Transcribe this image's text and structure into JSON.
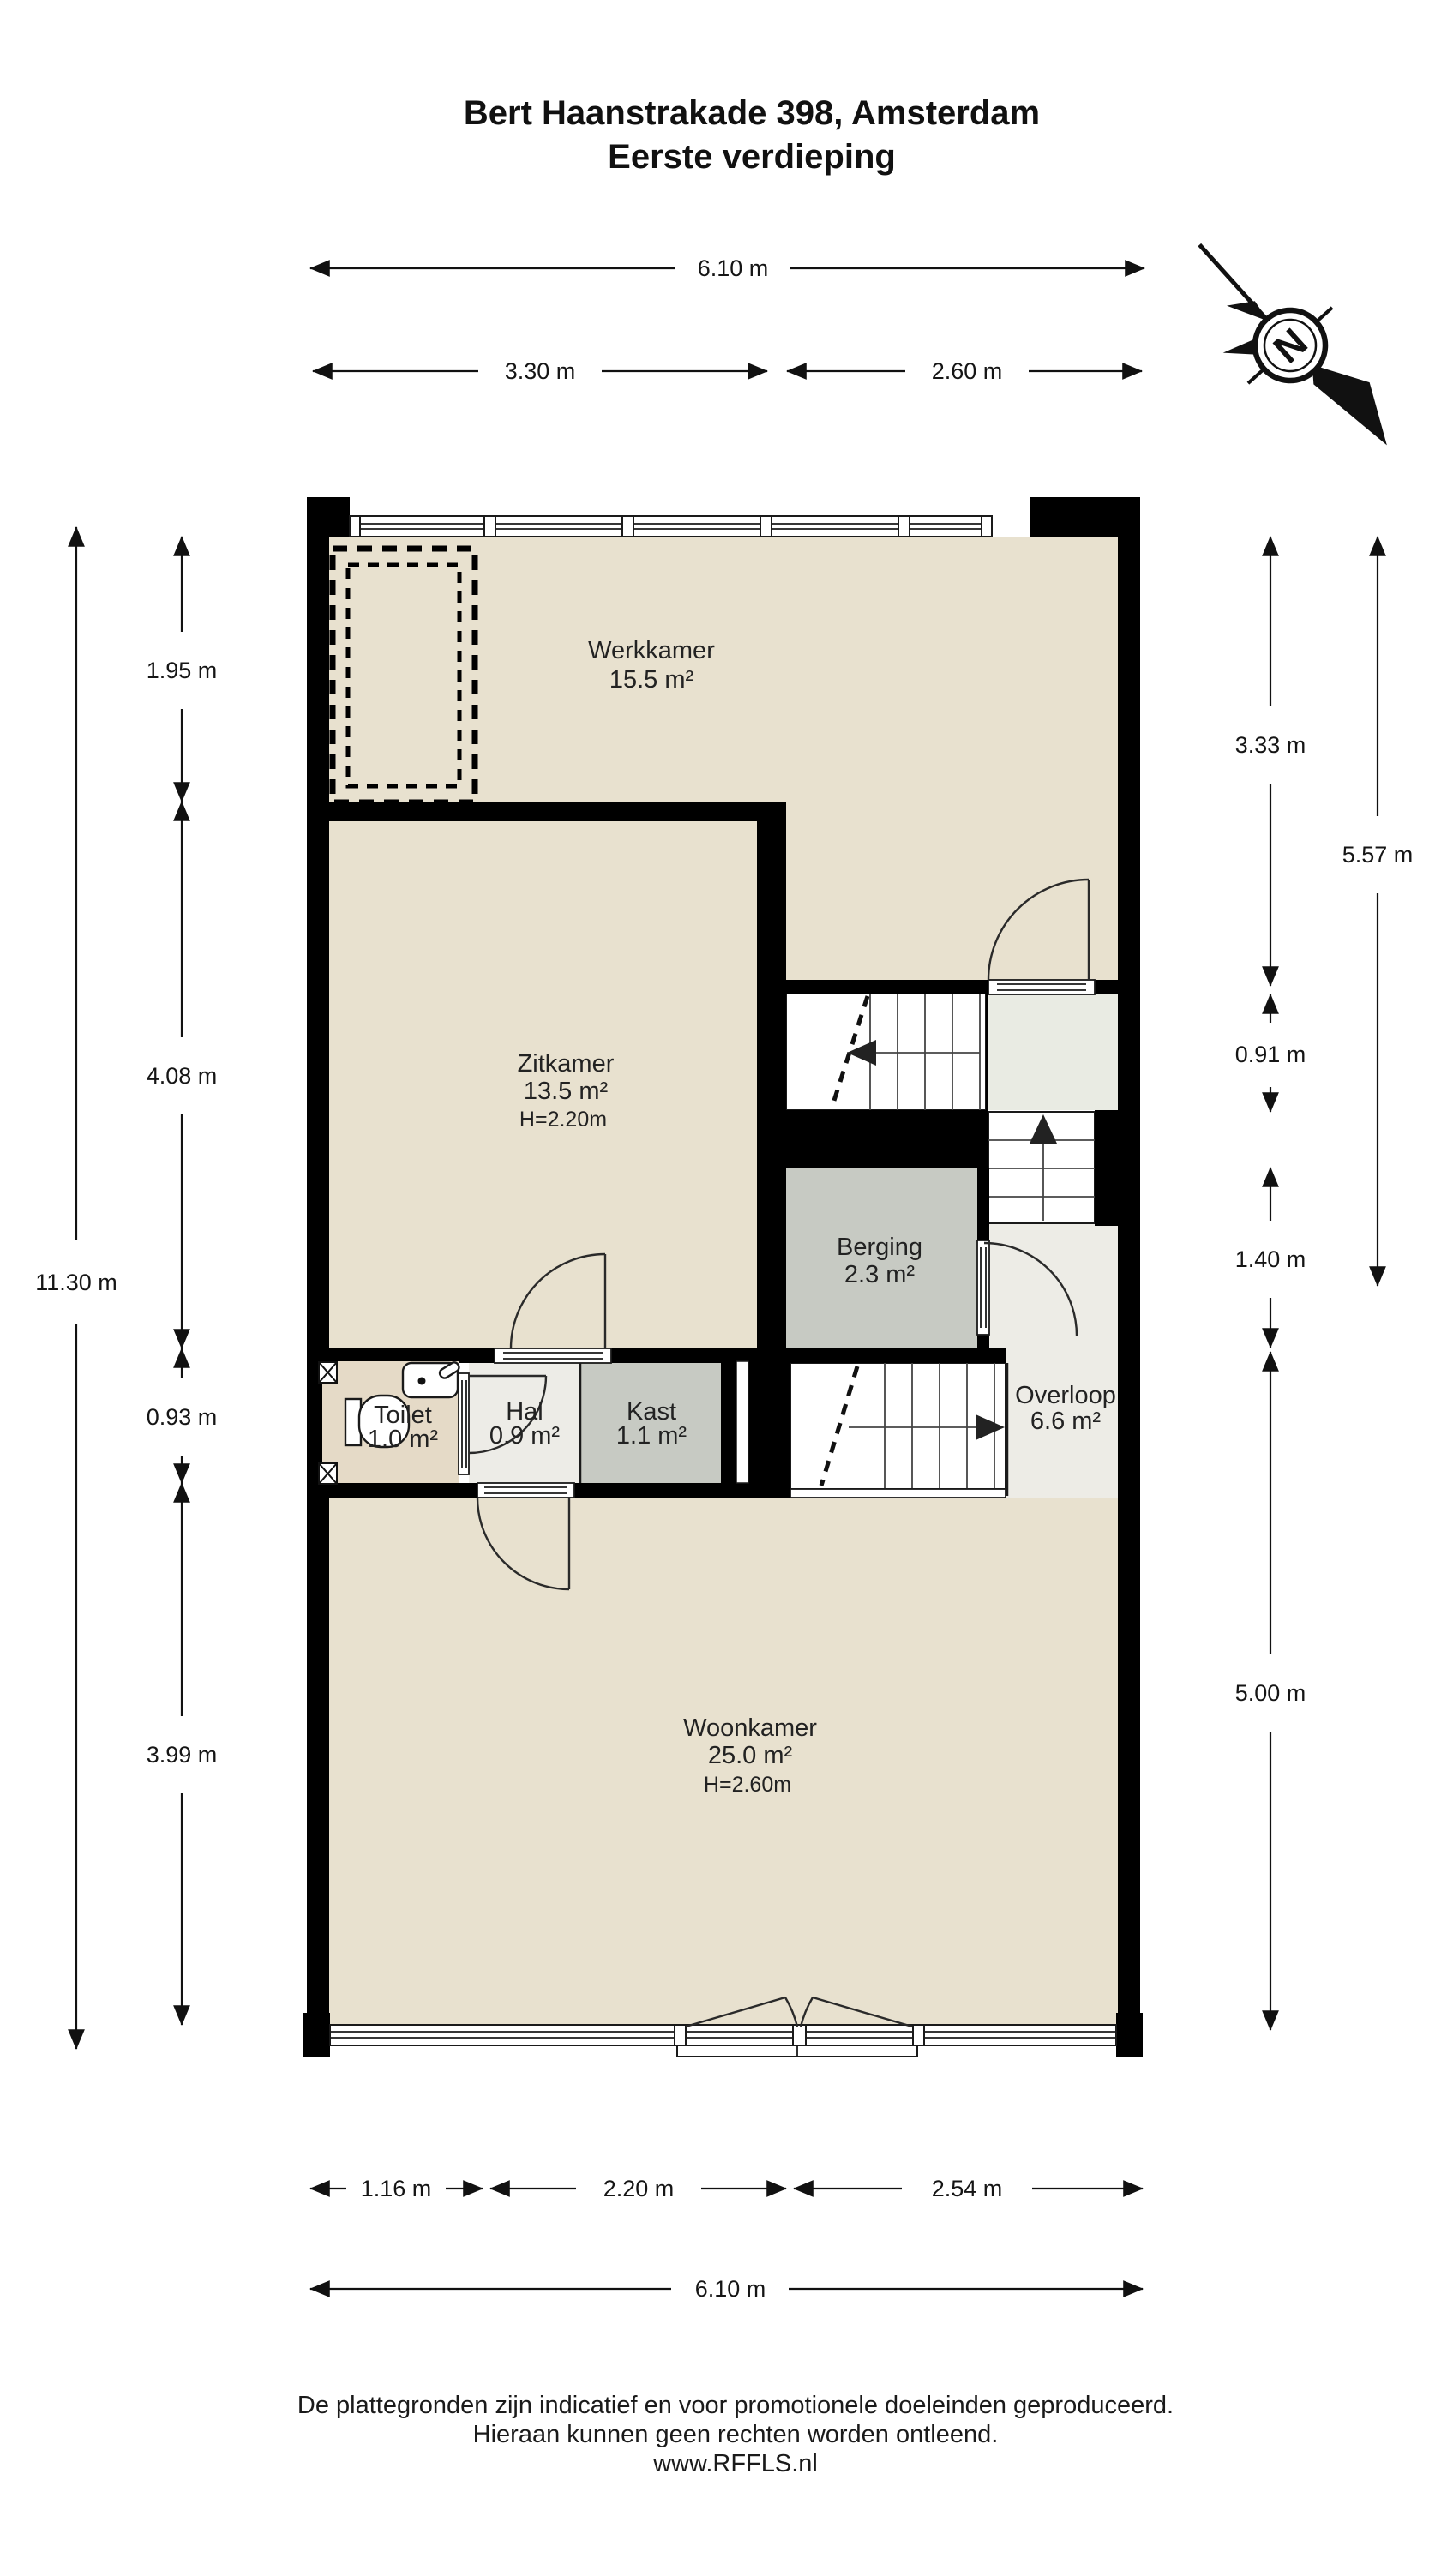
{
  "title": {
    "line1": "Bert Haanstrakade 398, Amsterdam",
    "line2": "Eerste verdieping"
  },
  "compass": {
    "north_label": "N"
  },
  "rooms": {
    "werkkamer": {
      "name": "Werkkamer",
      "area": "15.5 m²"
    },
    "zitkamer": {
      "name": "Zitkamer",
      "area": "13.5 m²",
      "ceiling": "H=2.20m"
    },
    "berging": {
      "name": "Berging",
      "area": "2.3 m²"
    },
    "toilet": {
      "name": "Toilet",
      "area": "1.0 m²"
    },
    "hal": {
      "name": "Hal",
      "area": "0.9 m²"
    },
    "kast": {
      "name": "Kast",
      "area": "1.1 m²"
    },
    "overloop": {
      "name": "Overloop",
      "area": "6.6 m²"
    },
    "woonkamer": {
      "name": "Woonkamer",
      "area": "25.0 m²",
      "ceiling": "H=2.60m"
    }
  },
  "dimensions": {
    "top": {
      "total": "6.10 m",
      "left": "3.30 m",
      "right": "2.60 m"
    },
    "bottom": {
      "total": "6.10 m",
      "segments": [
        "1.16 m",
        "2.20 m",
        "2.54 m"
      ]
    },
    "left": {
      "total": "11.30 m",
      "segments": [
        "1.95 m",
        "4.08 m",
        "0.93 m",
        "3.99 m"
      ]
    },
    "right": {
      "outer": "5.57 m",
      "segments": [
        "3.33 m",
        "0.91 m",
        "1.40 m",
        "5.00 m"
      ]
    }
  },
  "footer": {
    "line1": "De plattegronden zijn indicatief en voor promotionele doeleinden geproduceerd.",
    "line2": "Hieraan kunnen geen rechten worden ontleend.",
    "line3": "www.RFFLS.nl"
  },
  "colors": {
    "wall": "#000000",
    "floor_beige": "#e8e1cf",
    "toilet_floor": "#e5dac7",
    "closet_gray": "#c7cac3",
    "hall_light": "#edece7",
    "landing_light": "#e9ebe3",
    "background": "#ffffff"
  }
}
